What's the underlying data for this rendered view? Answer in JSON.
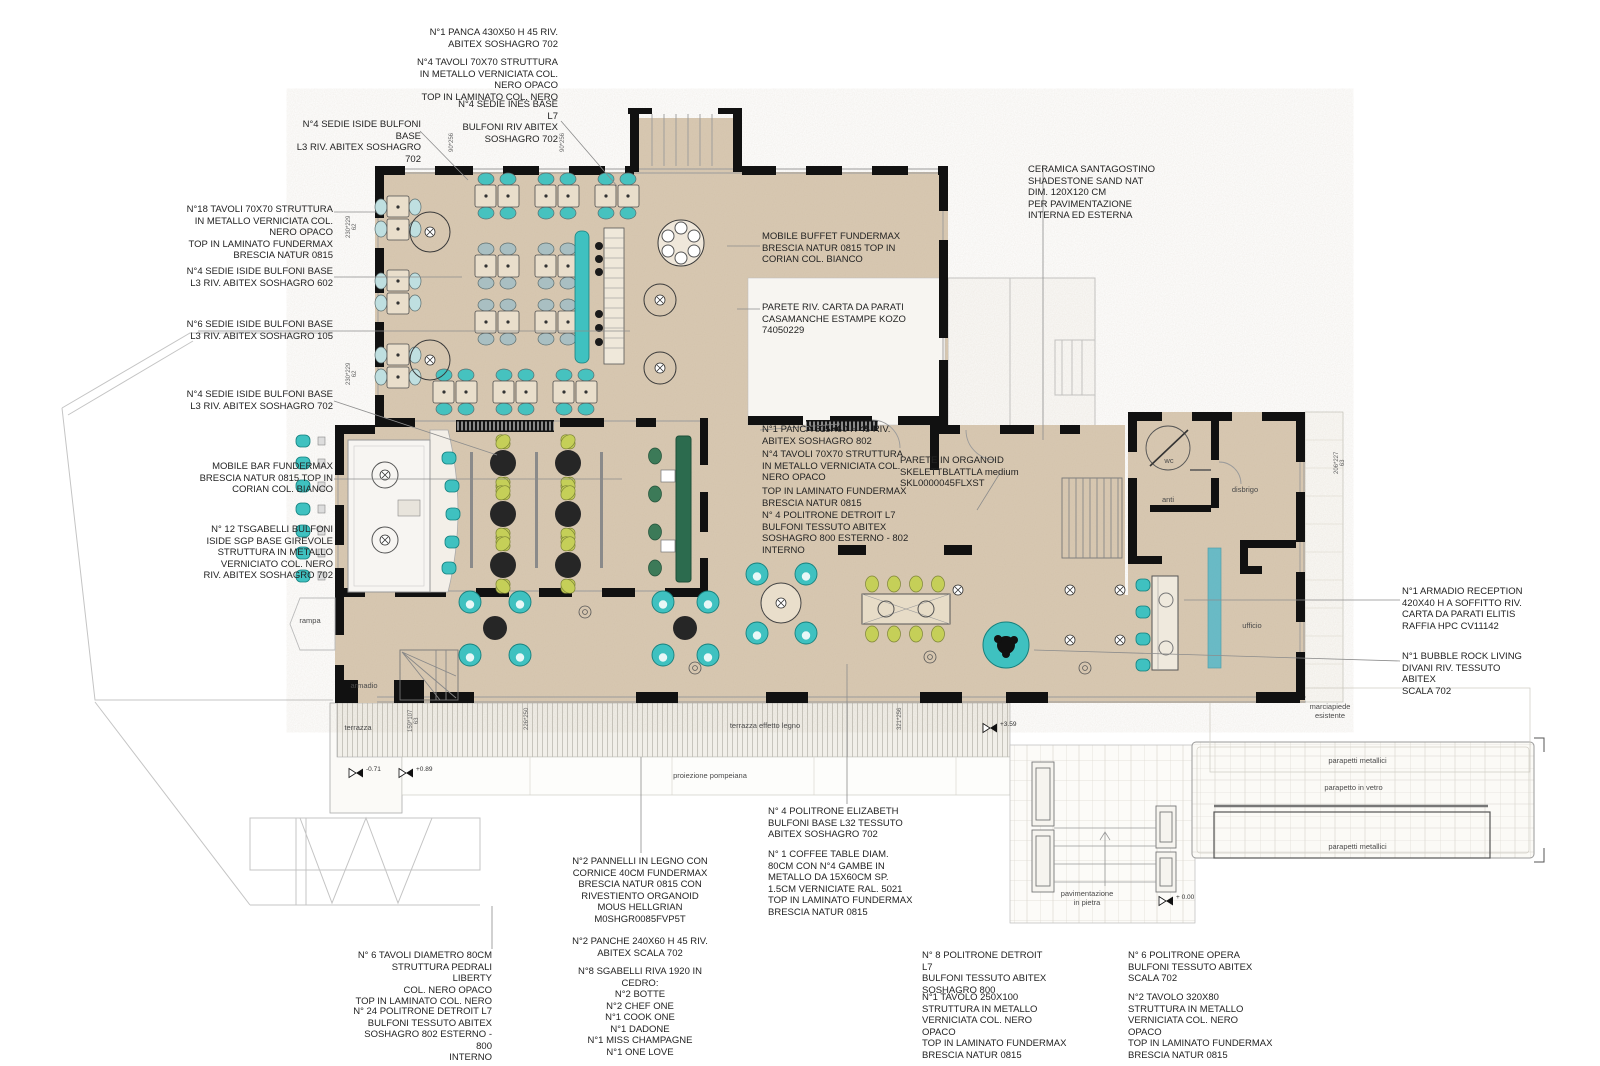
{
  "title": "restaurant-interior-floor-plan",
  "colors": {
    "floor": "#d9c9b2",
    "teal": "#3fc1c0",
    "lime": "#c5cf58",
    "dark_green": "#2c6b4e",
    "pale_chair": "#bfdfe0",
    "gray_chair": "#a9bfc2",
    "wall": "#111111",
    "white_room": "#f7f5f1"
  },
  "annotations": {
    "a1": "N°1 PANCA 430X50 H 45 RIV.\nABITEX SOSHAGRO 702",
    "a2": "N°4 TAVOLI 70X70 STRUTTURA\nIN METALLO  VERNICIATA COL.\nNERO OPACO\nTOP IN LAMINATO COL. NERO",
    "a3": "N°4 SEDIE INES BASE L7\nBULFONI RIV ABITEX\nSOSHAGRO 702",
    "a4": "N°4 SEDIE ISIDE BULFONI BASE\nL3 RIV. ABITEX SOSHAGRO 702",
    "a5": "N°18 TAVOLI 70X70 STRUTTURA\nIN METALLO  VERNICIATA COL.\nNERO OPACO\nTOP IN LAMINATO FUNDERMAX\nBRESCIA NATUR 0815",
    "a6": "N°4 SEDIE ISIDE BULFONI BASE\nL3 RIV. ABITEX SOSHAGRO 602",
    "a7": "N°6 SEDIE ISIDE BULFONI BASE\nL3 RIV. ABITEX SOSHAGRO 105",
    "a8": "N°4 SEDIE ISIDE BULFONI BASE\nL3 RIV. ABITEX SOSHAGRO 702",
    "a9": "MOBILE BAR FUNDERMAX\nBRESCIA NATUR 0815 TOP IN\nCORIAN COL. BIANCO",
    "a10": "N° 12 TSGABELLI BULFONI\nISIDE SGP BASE GIREVOLE\nSTRUTTURA IN METALLO\nVERNICIATO COL. NERO\nRIV. ABITEX SOSHAGRO 702",
    "a11": "MOBILE BUFFET FUNDERMAX\nBRESCIA NATUR 0815 TOP IN\nCORIAN COL. BIANCO",
    "a12": "PARETE RIV. CARTA DA PARATI\nCASAMANCHE ESTAMPE KOZO\n74050229",
    "a13": "N°1 PANCA 515X60 H 45 RIV.\nABITEX SOSHAGRO 802",
    "a14": "N°4 TAVOLI 70X70 STRUTTURA\nIN METALLO  VERNICIATA COL.\nNERO OPACO",
    "a15": "TOP IN LAMINATO FUNDERMAX\nBRESCIA NATUR 0815",
    "a16": "N° 4 POLITRONE DETROIT L7\nBULFONI TESSUTO ABITEX\nSOSHAGRO 800 ESTERNO - 802\nINTERNO",
    "a17": "PARETE IN ORGANOID\nSKELETTBLATTLA medium\nSKL0000045FLXST",
    "a18": "CERAMICA SANTAGOSTINO\nSHADESTONE SAND NAT\nDIM. 120X120 CM\nPER PAVIMENTAZIONE\nINTERNA ED ESTERNA",
    "a19": "N°1 ARMADIO RECEPTION\n420X40 H A SOFFITTO RIV.\nCARTA DA PARATI ELITIS\nRAFFIA HPC CV11142",
    "a20": "N°1 BUBBLE ROCK LIVING\nDIVANI RIV. TESSUTO ABITEX\nSCALA 702",
    "a21": "N° 4 POLITRONE ELIZABETH\nBULFONI BASE L32 TESSUTO\nABITEX SOSHAGRO 702",
    "a22": "N° 1 COFFEE TABLE DIAM.\n80CM CON N°4 GAMBE IN\nMETALLO DA 15X60CM SP.\n1.5CM VERNICIATE RAL. 5021\nTOP IN LAMINATO FUNDERMAX\nBRESCIA NATUR 0815",
    "a23": "N°2 PANNELLI IN LEGNO CON\nCORNICE 40CM FUNDERMAX\nBRESCIA NATUR 0815 CON\nRIVESTIENTO ORGANOID\nMOUS HELLGRIAN\nM0SHGR0085FVP5T",
    "a24": "N°2 PANCHE 240X60 H 45 RIV.\nABITEX SCALA 702",
    "a25": "N°8 SGABELLI RIVA 1920 IN\nCEDRO:\nN°2 BOTTE\nN°2 CHEF ONE\nN°1 COOK ONE\nN°1 DADONE\nN°1 MISS CHAMPAGNE\nN°1 ONE LOVE",
    "a26": "N° 6 TAVOLI DIAMETRO 80CM\nSTRUTTURA PEDRALI LIBERTY\nCOL. NERO OPACO\nTOP IN LAMINATO COL. NERO",
    "a27": "N° 24 POLITRONE DETROIT L7\nBULFONI TESSUTO ABITEX\nSOSHAGRO 802 ESTERNO - 800\nINTERNO",
    "a28": "N° 8 POLITRONE DETROIT L7\nBULFONI TESSUTO ABITEX\nSOSHAGRO 800",
    "a29": "N°1 TAVOLO 250X100\nSTRUTTURA IN METALLO\nVERNICIATA COL. NERO OPACO\nTOP IN LAMINATO FUNDERMAX\nBRESCIA NATUR 0815",
    "a30": "N° 6 POLITRONE OPERA\nBULFONI TESSUTO ABITEX\nSCALA 702",
    "a31": "N°2 TAVOLO 320X80\nSTRUTTURA IN METALLO\nVERNICIATA COL. NERO OPACO\nTOP IN LAMINATO FUNDERMAX\nBRESCIA NATUR 0815"
  },
  "plan_labels": {
    "rampa": "rampa",
    "armadio": "armadio",
    "terrazza": "terrazza",
    "legno": "terrazza effetto legno",
    "pompeiana": "proiezione pompeiana",
    "pietra": "pavimentazione\nin pietra",
    "par_top": "parapetti metallici",
    "vetro": "parapetto in vetro",
    "par_bottom": "parapetti metallici",
    "marciapiede": "marciapiede\nesistente",
    "wc": "wc",
    "anti": "anti",
    "disbrigo": "disbrigo",
    "ufficio": "ufficio"
  },
  "dims": {
    "d1": "230*229\n62",
    "d2": "230*229\n62",
    "d3": "90*256",
    "d4": "90*256",
    "d5": "159*107\n63",
    "d6": "226*250",
    "d7": "206*227\n63",
    "d8": "321*256"
  },
  "elevations": {
    "e1": "-0.71",
    "e2": "+0.89",
    "e3": "+3.59",
    "e4": "+ 0.00"
  }
}
